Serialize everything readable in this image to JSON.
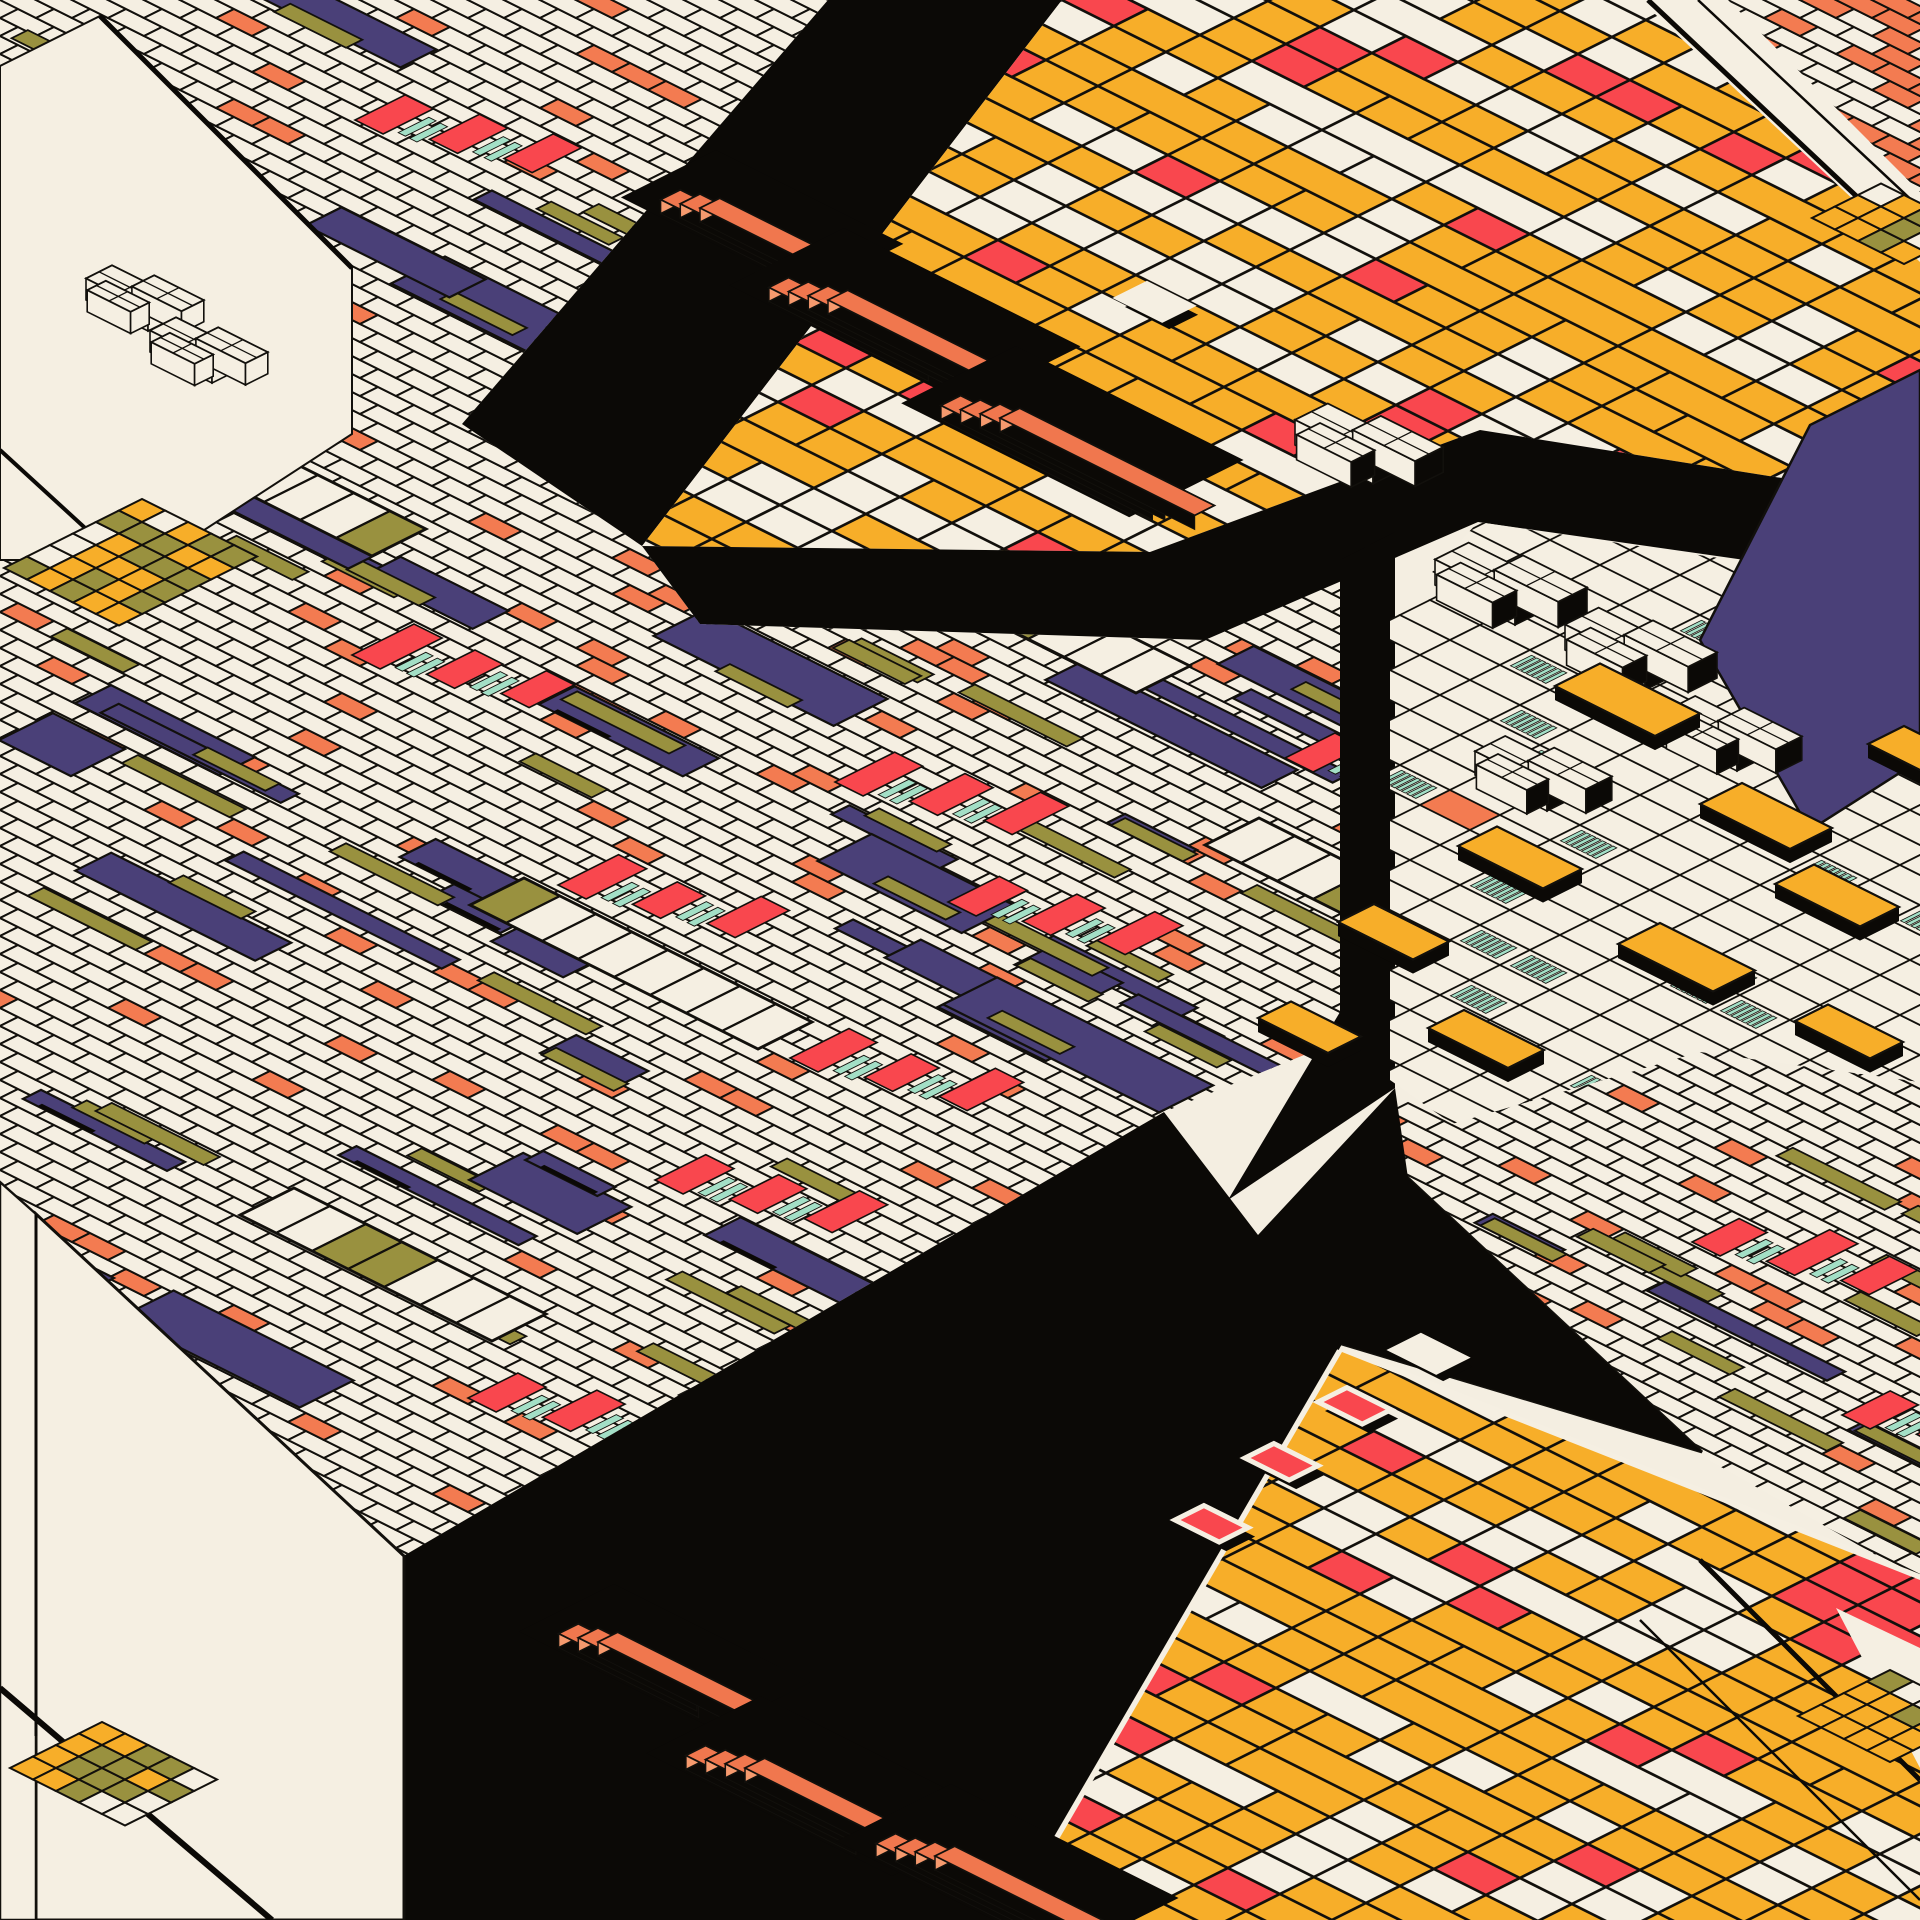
{
  "artwork": {
    "title": "Isometric generative composition — tiled grids, checkers and stacked slabs",
    "style": "isometric-2to1-generative"
  },
  "canvas": {
    "w": 1920,
    "h": 1920
  },
  "palette": {
    "background": "#F4EEE1",
    "cream": "#F5EFE2",
    "black": "#0B0906",
    "indigo": "#4A4078",
    "red": "#F9474E",
    "salmon": "#F37B51",
    "amber": "#F7AE29",
    "olive": "#99913F",
    "mint": "#A3DFC6",
    "slab_orange": "#F0774E",
    "slab_orange_light": "#F69A6E",
    "stroke": "#12100C"
  },
  "planes": {
    "fine_left": {
      "seed": 7,
      "origin": [
        0,
        0
      ],
      "u": [
        36,
        18
      ],
      "w": [
        18,
        -9
      ],
      "ir": [
        0,
        71
      ],
      "jr": [
        -88,
        42
      ],
      "p_salmon": 0.06,
      "n_indigo": 64,
      "n_olive": 42,
      "clip": [
        [
          0,
          0
        ],
        [
          828,
          0
        ],
        [
          462,
          424
        ],
        [
          642,
          546
        ],
        [
          700,
          624
        ],
        [
          1200,
          640
        ],
        [
          1390,
          548
        ],
        [
          1390,
          1020
        ],
        [
          1164,
          1112
        ],
        [
          400,
          1558
        ],
        [
          0,
          1212
        ]
      ]
    },
    "fine_right": {
      "seed": 11,
      "origin": [
        1390,
        1040
      ],
      "u": [
        36,
        18
      ],
      "w": [
        18,
        -9
      ],
      "ir": [
        -2,
        24
      ],
      "jr": [
        -32,
        17
      ],
      "p_salmon": 0.085,
      "n_indigo": 26,
      "n_olive": 16,
      "clip": [
        [
          1390,
          1088
        ],
        [
          1452,
          1124
        ],
        [
          1700,
          1052
        ],
        [
          1920,
          1082
        ],
        [
          1920,
          1580
        ],
        [
          1700,
          1455
        ],
        [
          1408,
          1178
        ]
      ]
    },
    "fine_tr": {
      "seed": 13,
      "origin": [
        1728,
        0
      ],
      "u": [
        36,
        18
      ],
      "w": [
        18,
        -9
      ],
      "ir": [
        -2,
        10
      ],
      "jr": [
        -12,
        7
      ],
      "p_salmon": 0.3,
      "n_indigo": 0,
      "n_olive": 0,
      "clip": [
        [
          1728,
          0
        ],
        [
          1920,
          0
        ],
        [
          1920,
          192
        ]
      ]
    },
    "checker_tr": {
      "seed": 3,
      "origin": [
        1062,
        0
      ],
      "u": [
        52,
        26
      ],
      "w": [
        34,
        -17
      ],
      "ir": [
        -5,
        28
      ],
      "jr": [
        -26,
        14
      ],
      "p_amber": 0.58,
      "p_cream": 0.3,
      "clip": [
        [
          1062,
          0
        ],
        [
          1920,
          0
        ],
        [
          1920,
          500
        ],
        [
          1480,
          430
        ],
        [
          1150,
          552
        ],
        [
          642,
          546
        ]
      ]
    },
    "checker_br": {
      "seed": 5,
      "origin": [
        1012,
        1352
      ],
      "u": [
        52,
        26
      ],
      "w": [
        34,
        -17
      ],
      "ir": [
        -2,
        21
      ],
      "jr": [
        -18,
        15
      ],
      "p_amber": 0.58,
      "p_cream": 0.3,
      "clip": [
        [
          1342,
          1352
        ],
        [
          1920,
          1580
        ],
        [
          1920,
          1920
        ],
        [
          1012,
          1920
        ]
      ]
    },
    "mosaic": {
      "seed": 9,
      "origin": [
        1390,
        520
      ],
      "u": [
        50,
        25
      ],
      "w": [
        30,
        -15
      ],
      "ir": [
        -1,
        19
      ],
      "jr": [
        -22,
        10
      ],
      "p_hatch": 0.1,
      "p_hatch_left": 0.26,
      "p_salmon": 0.015,
      "clip": [
        [
          1390,
          618
        ],
        [
          1478,
          522
        ],
        [
          1920,
          588
        ],
        [
          1920,
          1082
        ],
        [
          1700,
          1052
        ],
        [
          1452,
          1124
        ],
        [
          1390,
          1080
        ]
      ]
    }
  },
  "black_regions": [
    [
      [
        828,
        0
      ],
      [
        1062,
        0
      ],
      [
        642,
        546
      ],
      [
        462,
        424
      ]
    ],
    [
      [
        642,
        546
      ],
      [
        1150,
        552
      ],
      [
        1480,
        430
      ],
      [
        1920,
        500
      ],
      [
        1920,
        585
      ],
      [
        1478,
        522
      ],
      [
        1205,
        640
      ],
      [
        700,
        624
      ]
    ],
    [
      [
        1340,
        560
      ],
      [
        1395,
        532
      ],
      [
        1395,
        1088
      ],
      [
        1228,
        1200
      ],
      [
        1340,
        1012
      ]
    ],
    [
      [
        400,
        1558
      ],
      [
        1164,
        1112
      ],
      [
        1258,
        1235
      ],
      [
        1395,
        1088
      ],
      [
        1408,
        1178
      ],
      [
        1702,
        1452
      ],
      [
        1342,
        1344
      ],
      [
        1012,
        1920
      ],
      [
        404,
        1920
      ]
    ],
    [
      [
        1872,
        120
      ],
      [
        1920,
        164
      ],
      [
        1920,
        204
      ],
      [
        1892,
        168
      ]
    ]
  ],
  "cream_faces": [
    {
      "pts": [
        [
          36,
          1214
        ],
        [
          404,
          1556
        ],
        [
          404,
          1920
        ],
        [
          36,
          1920
        ]
      ],
      "sw": 3
    },
    {
      "pts": [
        [
          0,
          1182
        ],
        [
          36,
          1214
        ],
        [
          36,
          1920
        ],
        [
          0,
          1920
        ]
      ],
      "sw": 2.5
    },
    {
      "pts": [
        [
          1408,
          1178
        ],
        [
          1702,
          1452
        ],
        [
          1342,
          1344
        ]
      ],
      "sw": 3
    },
    {
      "pts": [
        [
          1640,
          0
        ],
        [
          1920,
          0
        ],
        [
          1920,
          262
        ]
      ],
      "sw": 0
    },
    {
      "pts": [
        [
          1836,
          1608
        ],
        [
          1920,
          1648
        ],
        [
          1920,
          1768
        ]
      ],
      "sw": 0
    },
    {
      "pts": [
        [
          0,
          66
        ],
        [
          100,
          16
        ],
        [
          352,
          268
        ],
        [
          352,
          434
        ],
        [
          158,
          560
        ],
        [
          0,
          560
        ]
      ],
      "sw": 0
    }
  ],
  "seams": [
    {
      "a": [
        100,
        16
      ],
      "b": [
        352,
        268
      ],
      "sw": 5
    },
    {
      "a": [
        0,
        450
      ],
      "b": [
        120,
        560
      ],
      "sw": 4
    },
    {
      "a": [
        36,
        1214
      ],
      "b": [
        36,
        1736
      ],
      "sw": 3
    },
    {
      "a": [
        0,
        1688
      ],
      "b": [
        272,
        1920
      ],
      "sw": 6
    },
    {
      "a": [
        1648,
        0
      ],
      "b": [
        1920,
        256
      ],
      "sw": 5
    },
    {
      "a": [
        1698,
        0
      ],
      "b": [
        1920,
        208
      ],
      "sw": 2.5
    },
    {
      "a": [
        1700,
        1560
      ],
      "b": [
        1920,
        1780
      ],
      "sw": 5
    },
    {
      "a": [
        1640,
        1620
      ],
      "b": [
        1920,
        1900
      ],
      "sw": 2.5
    },
    {
      "a": [
        1012,
        1920
      ],
      "b": [
        1342,
        1352
      ],
      "sw": 11,
      "color": "cream"
    },
    {
      "a": [
        1342,
        1352
      ],
      "b": [
        1920,
        1580
      ],
      "sw": 11,
      "color": "cream"
    }
  ],
  "stair_clusters": [
    {
      "x": 700,
      "y": 208,
      "n": 3,
      "len": 150
    },
    {
      "x": 828,
      "y": 300,
      "n": 4,
      "len": 205
    },
    {
      "x": 1000,
      "y": 418,
      "n": 4,
      "len": 195
    },
    {
      "x": 598,
      "y": 1642,
      "n": 3,
      "len": 160
    },
    {
      "x": 745,
      "y": 1768,
      "n": 4,
      "len": 215
    },
    {
      "x": 935,
      "y": 1856,
      "n": 4,
      "len": 195
    }
  ],
  "accent_clusters": {
    "fine_left": [
      [
        355,
        120
      ],
      [
        545,
        330
      ],
      [
        352,
        655
      ],
      [
        558,
        885
      ],
      [
        835,
        782
      ],
      [
        948,
        902
      ],
      [
        655,
        1180
      ],
      [
        468,
        1398
      ],
      [
        790,
        1058
      ],
      [
        1048,
        182
      ],
      [
        1285,
        758
      ],
      [
        898,
        472
      ]
    ],
    "fine_right": [
      [
        1692,
        1242
      ],
      [
        1842,
        1415
      ]
    ]
  },
  "piano_bands": [
    {
      "x": 120,
      "y": 430,
      "n": 7
    },
    {
      "x": 470,
      "y": 905,
      "n": 8
    },
    {
      "x": 920,
      "y": 585,
      "n": 6
    },
    {
      "x": 1000,
      "y": 345,
      "n": 5
    },
    {
      "x": 240,
      "y": 1215,
      "n": 7
    },
    {
      "x": 680,
      "y": 1395,
      "n": 6
    },
    {
      "x": 1205,
      "y": 845,
      "n": 6
    }
  ],
  "box_clusters": [
    {
      "x": 1435,
      "y": 585,
      "s": 0.8,
      "dark": true
    },
    {
      "x": 1565,
      "y": 650,
      "s": 0.8,
      "dark": true
    },
    {
      "x": 1665,
      "y": 735,
      "s": 0.72,
      "dark": true
    },
    {
      "x": 1475,
      "y": 775,
      "s": 0.72,
      "dark": true
    },
    {
      "x": 1295,
      "y": 445,
      "s": 0.78,
      "dark": true
    },
    {
      "x": 86,
      "y": 300,
      "s": 0.62,
      "dark": false
    },
    {
      "x": 150,
      "y": 352,
      "s": 0.62,
      "dark": false
    },
    {
      "x": 108,
      "y": 1852,
      "s": 0.6,
      "dark": false
    }
  ],
  "yellow_tiles": [
    {
      "x": 1555,
      "y": 700,
      "du": 2.0,
      "dw": 1.5
    },
    {
      "x": 1700,
      "y": 818,
      "du": 1.8,
      "dw": 1.4
    },
    {
      "x": 1458,
      "y": 860,
      "du": 1.7,
      "dw": 1.3
    },
    {
      "x": 1338,
      "y": 936,
      "du": 1.5,
      "dw": 1.2
    },
    {
      "x": 1618,
      "y": 958,
      "du": 1.9,
      "dw": 1.4
    },
    {
      "x": 1775,
      "y": 898,
      "du": 1.7,
      "dw": 1.3
    },
    {
      "x": 1868,
      "y": 758,
      "du": 1.6,
      "dw": 1.2
    },
    {
      "x": 1258,
      "y": 1032,
      "du": 1.4,
      "dw": 1.1
    },
    {
      "x": 1428,
      "y": 1042,
      "du": 1.6,
      "dw": 1.2
    },
    {
      "x": 1795,
      "y": 1035,
      "du": 1.5,
      "dw": 1.1
    }
  ],
  "indigo_diamond": [
    [
      1700,
      640
    ],
    [
      1810,
      425
    ],
    [
      1920,
      370
    ],
    [
      1920,
      760
    ],
    [
      1810,
      830
    ]
  ],
  "indigo_patches": [
    {
      "x": -46,
      "y": 472,
      "du": 4,
      "dw": 2
    },
    {
      "x": -30,
      "y": 1242,
      "du": 3,
      "dw": 2
    },
    {
      "x": 1340,
      "y": 530,
      "du": 2,
      "dw": 1.4
    }
  ],
  "edge_cells": [
    {
      "x": 930,
      "y": 340,
      "c": "cream"
    },
    {
      "x": 988,
      "y": 395,
      "c": "red"
    },
    {
      "x": 1052,
      "y": 448,
      "c": "red"
    },
    {
      "x": 1118,
      "y": 298,
      "c": "cream"
    },
    {
      "x": 1245,
      "y": 1458,
      "c": "red"
    },
    {
      "x": 1318,
      "y": 1402,
      "c": "red"
    },
    {
      "x": 1392,
      "y": 1350,
      "c": "cream"
    },
    {
      "x": 1175,
      "y": 1520,
      "c": "red"
    }
  ],
  "mini_checkers": [
    {
      "x": 4,
      "y": 568,
      "cols": 5,
      "rows": 6,
      "cell": 23,
      "seed": 17
    },
    {
      "x": 10,
      "y": 1768,
      "cols": 5,
      "rows": 4,
      "cell": 23,
      "seed": 19
    },
    {
      "x": 1812,
      "y": 218,
      "cols": 4,
      "rows": 3,
      "cell": 23,
      "seed": 23
    },
    {
      "x": 1798,
      "y": 1716,
      "cols": 4,
      "rows": 4,
      "cell": 23,
      "seed": 29
    }
  ],
  "geometry": {
    "stair_width": 22,
    "stair_height": 14,
    "box_lift": 22,
    "tile_lift": 14,
    "stroke_fine": 2,
    "stroke_checker": 2.6,
    "stroke_mosaic": 1.8,
    "stroke_panel": 2.2
  }
}
